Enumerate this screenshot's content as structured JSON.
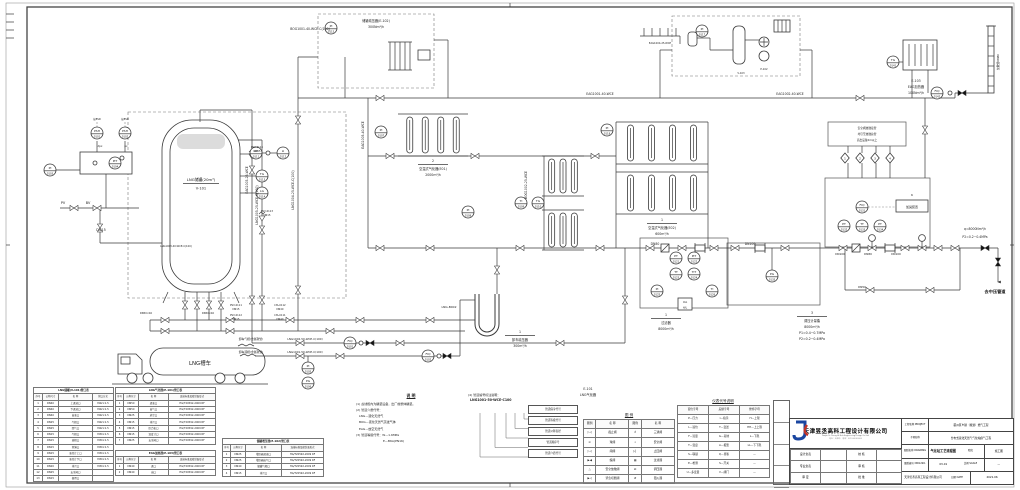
{
  "diagram": {
    "gray_note": "接ESD",
    "tank": {
      "name": "LNG储罐(20m³)",
      "tag": "V-101"
    },
    "truck": "LNG槽车",
    "odorizer": {
      "tag": "6",
      "label": "加臭装置"
    },
    "vent_note_lines": [
      "安全阀放散接管",
      "均引至放散总管",
      "高出设备2m以上"
    ],
    "diamonds": [
      "1",
      "2",
      "3",
      "4"
    ],
    "instruments": [
      {
        "x": 97,
        "y": 133,
        "a": "PSH",
        "b": "0101"
      },
      {
        "x": 125,
        "y": 133,
        "a": "PSH",
        "b": "0102"
      },
      {
        "x": 50,
        "y": 170,
        "a": "PI",
        "b": "0103"
      },
      {
        "x": 115,
        "y": 163,
        "a": "PIT",
        "b": "0104"
      },
      {
        "x": 256,
        "y": 153,
        "a": "LIT",
        "b": "0111"
      },
      {
        "x": 283,
        "y": 153,
        "a": "LI",
        "b": "0112"
      },
      {
        "x": 262,
        "y": 176,
        "a": "TG",
        "b": "0113"
      },
      {
        "x": 262,
        "y": 193,
        "a": "LG",
        "b": "0114"
      },
      {
        "x": 308,
        "y": 368,
        "a": "PI",
        "b": "0105"
      },
      {
        "x": 308,
        "y": 383,
        "a": "PG",
        "b": "0106"
      },
      {
        "x": 350,
        "y": 343,
        "a": "FIQ",
        "b": "0101"
      },
      {
        "x": 428,
        "y": 356,
        "a": "FIQ",
        "b": "0102"
      },
      {
        "x": 381,
        "y": 132,
        "a": "PI",
        "b": "0107"
      },
      {
        "x": 468,
        "y": 212,
        "a": "PI",
        "b": "0108"
      },
      {
        "x": 521,
        "y": 203,
        "a": "TI",
        "b": "0109"
      },
      {
        "x": 538,
        "y": 203,
        "a": "TG",
        "b": "0110"
      },
      {
        "x": 331,
        "y": 28,
        "a": "PI",
        "b": "0115"
      },
      {
        "x": 702,
        "y": 31,
        "a": "PI",
        "b": "0117"
      },
      {
        "x": 607,
        "y": 130,
        "a": "PI",
        "b": "0118"
      },
      {
        "x": 676,
        "y": 258,
        "a": "PT",
        "b": "0121"
      },
      {
        "x": 694,
        "y": 258,
        "a": "PIT",
        "b": "0122"
      },
      {
        "x": 676,
        "y": 274,
        "a": "TT",
        "b": "0123"
      },
      {
        "x": 694,
        "y": 274,
        "a": "TIT",
        "b": "0124"
      },
      {
        "x": 657,
        "y": 291,
        "a": "PI",
        "b": "0125"
      },
      {
        "x": 712,
        "y": 291,
        "a": "TI",
        "b": "0126"
      },
      {
        "x": 685,
        "y": 304,
        "a": "UA",
        "b": "H/L",
        "rect": 1
      },
      {
        "x": 862,
        "y": 207,
        "a": "FIQ",
        "b": "0131"
      },
      {
        "x": 844,
        "y": 226,
        "a": "PT",
        "b": "0132"
      },
      {
        "x": 862,
        "y": 226,
        "a": "TT",
        "b": "0133"
      },
      {
        "x": 880,
        "y": 226,
        "a": "PT",
        "b": "0134"
      },
      {
        "x": 772,
        "y": 276,
        "a": "PG",
        "b": "0135"
      },
      {
        "x": 893,
        "y": 62,
        "a": "TG",
        "b": "0141"
      },
      {
        "x": 937,
        "y": 93,
        "a": "FIQ",
        "b": "0142"
      }
    ],
    "pipe_labels": [
      {
        "x": 310,
        "y": 30,
        "t": "BOG1001-40-WCE-C(100)"
      },
      {
        "x": 600,
        "y": 95,
        "t": "EAG1001-40-WCE"
      },
      {
        "x": 790,
        "y": 95,
        "t": "EAG1002-40-WCE"
      },
      {
        "x": 660,
        "y": 44,
        "t": "EAG1004-25-WCE",
        "s": 2.5
      },
      {
        "x": 364,
        "y": 135,
        "t": "EAG1005-40-WCE",
        "r": -90
      },
      {
        "x": 248,
        "y": 180,
        "t": "EAG1003-25-WCE",
        "r": -90
      },
      {
        "x": 258,
        "y": 205,
        "t": "LNG1005-25-WCE-C(100)",
        "r": -90
      },
      {
        "x": 294,
        "y": 190,
        "t": "LNG1004-25-WCE-C(100)",
        "r": -90
      },
      {
        "x": 527,
        "y": 185,
        "t": "BOG1002-25-WCE",
        "r": -90
      },
      {
        "x": 176,
        "y": 247,
        "t": "LNG1003-40-WCE-C(100)",
        "s": 2.5
      },
      {
        "x": 257,
        "y": 148,
        "t": "PSV-0114",
        "s": 2.5
      },
      {
        "x": 257,
        "y": 152,
        "t": "DN15",
        "s": 2.5
      },
      {
        "x": 267,
        "y": 212,
        "t": "PSV-0113",
        "s": 2.5
      },
      {
        "x": 267,
        "y": 216,
        "t": "DN15",
        "s": 2.5
      },
      {
        "x": 236,
        "y": 306,
        "t": "PSV-0111",
        "s": 2.5
      },
      {
        "x": 236,
        "y": 310,
        "t": "DN15",
        "s": 2.5
      },
      {
        "x": 236,
        "y": 316,
        "t": "PSV-0112",
        "s": 2.5
      },
      {
        "x": 236,
        "y": 320,
        "t": "DN15",
        "s": 2.5
      },
      {
        "x": 280,
        "y": 306,
        "t": "LTA-0112",
        "s": 2.5
      },
      {
        "x": 280,
        "y": 310,
        "t": "DN40",
        "s": 2.5
      },
      {
        "x": 280,
        "y": 316,
        "t": "LTA-0111",
        "s": 2.5
      },
      {
        "x": 280,
        "y": 320,
        "t": "DN40",
        "s": 2.5
      },
      {
        "x": 146,
        "y": 314,
        "t": "DN50×40",
        "s": 2.5
      },
      {
        "x": 208,
        "y": 314,
        "t": "DN50×40",
        "s": 2.5
      },
      {
        "x": 251,
        "y": 340,
        "t": "卸车气相(金属软管)",
        "s": 2.8
      },
      {
        "x": 251,
        "y": 353,
        "t": "卸车液相(金属软管)",
        "s": 2.8
      },
      {
        "x": 305,
        "y": 340,
        "t": "LNG1002-50-WCE-C(100)",
        "s": 2.8
      },
      {
        "x": 305,
        "y": 353,
        "t": "LNG1001-50-WCE-C(100)",
        "s": 2.8
      },
      {
        "x": 449,
        "y": 308,
        "t": "LNG-B002",
        "s": 3
      },
      {
        "x": 655,
        "y": 245,
        "t": "DN80"
      },
      {
        "x": 750,
        "y": 245,
        "t": "DN100"
      },
      {
        "x": 840,
        "y": 255,
        "t": "DN100",
        "s": 2.8
      },
      {
        "x": 868,
        "y": 255,
        "t": "DN80",
        "s": 2.8
      },
      {
        "x": 896,
        "y": 255,
        "t": "DN100",
        "s": 2.8
      },
      {
        "x": 862,
        "y": 288,
        "t": "DN50",
        "s": 2.8
      },
      {
        "x": 975,
        "y": 230,
        "t": "q=8000Nm³/h"
      },
      {
        "x": 975,
        "y": 238,
        "t": "P2=0.2~0.4MPa"
      },
      {
        "x": 995,
        "y": 293,
        "t": "去中压管道",
        "s": 4.2,
        "b": 1
      },
      {
        "x": 101,
        "y": 231,
        "t": "DN15",
        "s": 3.4
      },
      {
        "x": 63,
        "y": 204,
        "t": "PV",
        "s": 3.4
      },
      {
        "x": 88,
        "y": 204,
        "t": "BV",
        "s": 3.4
      },
      {
        "x": 741,
        "y": 74,
        "t": "V-103",
        "s": 2.5
      },
      {
        "x": 764,
        "y": 70,
        "t": "P-102",
        "s": 2.5
      },
      {
        "x": 999,
        "y": 62,
        "t": "放散管DN80",
        "r": -90,
        "s": 2.8
      }
    ],
    "captions": [
      {
        "x": 433,
        "y": 162,
        "n": "2",
        "lines": [
          "空温式气化器(E01)",
          "2000m³/h"
        ]
      },
      {
        "x": 662,
        "y": 221,
        "n": "1",
        "lines": [
          "空温式气化器(E02)",
          "600m³/h"
        ]
      },
      {
        "x": 520,
        "y": 333,
        "n": "1",
        "lines": [
          "卸车增压器",
          "300m³/h"
        ]
      },
      {
        "x": 666,
        "y": 316,
        "n": "1",
        "lines": [
          "过滤器",
          "8000m³/h"
        ]
      },
      {
        "x": 812,
        "y": 314,
        "n": "3",
        "lines": [
          "调压计量撬",
          "8000m³/h",
          "P1=0.4~0.7MPa",
          "P2=0.2~0.4MPa"
        ]
      },
      {
        "x": 916,
        "y": 82,
        "lines": [
          "E-103",
          "EAG加热器",
          "100Nm³/h"
        ]
      },
      {
        "x": 376,
        "y": 22,
        "lines": [
          "储罐增压器(E-102)",
          "300Nm³/h"
        ]
      },
      {
        "x": 588,
        "y": 390,
        "lines": [
          "E-101",
          "LNG气化器"
        ]
      }
    ]
  },
  "notes": {
    "title": "说  明",
    "items": [
      "(1) 虚线框内为橇装设备，出厂前整体橇装。",
      "(2) 管道介质代号：",
      "　LNG—液化天然气",
      "　BOG—液化天然气蒸发气体",
      "　EAG—放空天然气",
      "(3) 管道等级代号：W—1.6MPa",
      "　　　　　　　　　E—B6A(PN16)"
    ]
  },
  "note4": {
    "title": "(4) 管道编号标注说明：",
    "code": "LNG1001-50-WCE-C100",
    "callouts": [
      "管道保冷代号",
      "管道等级代号",
      "管道公称直径",
      "管道顺序号",
      "管道介质代号"
    ]
  },
  "legend": {
    "title": "图  例",
    "table": {
      "headers": [
        "图例",
        "名 称",
        "图例",
        "名 称"
      ],
      "widths": [
        12,
        32,
        12,
        32
      ],
      "rows": [
        [
          "▷◁",
          "截止阀",
          "♁",
          "三通阀"
        ],
        [
          "⊙",
          "球阀",
          "⌖",
          "安全阀"
        ],
        [
          "▷◁",
          "闸阀",
          "▷▏",
          "止回阀"
        ],
        [
          "▶◀",
          "蝶阀",
          "▦",
          "过滤器"
        ],
        [
          "△",
          "安全放散阀",
          "Ω",
          "调压器"
        ],
        [
          "▶◁",
          "紧急切断阀",
          "#",
          "阻火器"
        ]
      ]
    }
  },
  "inst_code": {
    "title": "仪表代号说明",
    "table": {
      "headers": [
        "首位字母",
        "后继字母",
        "修饰字母"
      ],
      "widths": [
        31,
        31,
        30
      ],
      "rows": [
        [
          "P—压力",
          "I—指示",
          "H—上限"
        ],
        [
          "L—液位",
          "T—变送",
          "HH—上上限"
        ],
        [
          "F—流量",
          "G—就地",
          "L—下限"
        ],
        [
          "T—温度",
          "A—报警",
          "LL—下下限"
        ],
        [
          "S—联锁",
          "Q—累积",
          "—"
        ],
        [
          "E—检测",
          "S—开关",
          "—"
        ],
        [
          "U—多变量",
          "V—阀门",
          "—"
        ]
      ]
    }
  },
  "tables": {
    "t1": {
      "title": "LNG储罐(V-101)管口表",
      "headers": [
        "序号",
        "公称尺寸",
        "名 称",
        "管口方式"
      ],
      "widths": [
        9,
        16,
        34,
        21
      ],
      "rows": [
        [
          "1",
          "DN40",
          "上进液口",
          "M42×1.5"
        ],
        [
          "2",
          "DN40",
          "下进液口",
          "M42×1.5"
        ],
        [
          "3",
          "DN40",
          "出液口",
          "M42×1.5"
        ],
        [
          "4",
          "DN25",
          "气相口",
          "M42×1.5"
        ],
        [
          "5",
          "DN25",
          "回气口",
          "M42×1.5"
        ],
        [
          "6",
          "DN15",
          "气相口",
          "M30×1.5"
        ],
        [
          "7",
          "DN15",
          "液相口",
          "M30×1.5"
        ],
        [
          "8",
          "DN15",
          "测满口",
          "M30×1.5"
        ],
        [
          "9",
          "DN15",
          "液位计上口",
          "M30×1.5"
        ],
        [
          "10",
          "DN15",
          "液位计下口",
          "M30×1.5"
        ],
        [
          "11",
          "DN20",
          "排污口",
          "M30×1.5"
        ],
        [
          "12",
          "DN25",
          "安全阀口",
          ""
        ],
        [
          "13",
          "DN15",
          "备用口",
          ""
        ]
      ]
    },
    "t2": {
      "title": "LNG气化器(E-101)管口表",
      "headers": [
        "序号",
        "公称尺寸",
        "名 称",
        "连接标准及密封面形式"
      ],
      "widths": [
        8,
        15,
        30,
        47
      ],
      "rows": [
        [
          "1",
          "DN50",
          "进液口",
          "HG/T20592-2009 RF"
        ],
        [
          "2",
          "DN50",
          "出气口",
          "HG/T20592-2009 RF"
        ],
        [
          "3",
          "DN25",
          "放空口",
          "HG/T20592-2009 RF"
        ],
        [
          "4",
          "DN15",
          "排污口",
          "HG/T20592-2009 RF"
        ],
        [
          "5",
          "DN15",
          "压力表口",
          "HG/T20592-2009 RF"
        ],
        [
          "6",
          "DN15",
          "温度计口",
          "HG/T20592-2009 RF"
        ],
        [
          "7",
          "DN25",
          "安全阀口",
          "HG/T20592-2009 RF"
        ]
      ]
    },
    "t2b": {
      "title": "EAG加热器(E-103)管口表",
      "headers": [
        "序号",
        "公称尺寸",
        "名 称",
        "连接标准及密封面形式"
      ],
      "widths": [
        8,
        15,
        30,
        47
      ],
      "rows": [
        [
          "1",
          "DN40",
          "进口",
          "HG/T20592-2009 RF"
        ],
        [
          "2",
          "DN40",
          "出口",
          "HG/T20592-2009 RF"
        ]
      ]
    },
    "t3": {
      "title": "储罐增压器(E-102)管口表",
      "headers": [
        "序号",
        "公称尺寸",
        "名 称",
        "连接标准及密封面形式"
      ],
      "widths": [
        8,
        15,
        36,
        42
      ],
      "rows": [
        [
          "1",
          "DN25",
          "增压器进液口",
          "HG/T20592-2009 RF"
        ],
        [
          "2",
          "DN25",
          "增压器出气口",
          "HG/T20592-2009 RF"
        ],
        [
          "3",
          "DN40",
          "储罐气相口",
          "HG/T20592-2009 RF"
        ],
        [
          "4",
          "DN15",
          "排污口",
          "HG/T20592-2009 RF"
        ]
      ]
    }
  },
  "titleblock": {
    "company": "天津昱丞高科工程设计有限公司",
    "company_en": "Tianjin Yu Cheng Hi-Tech Engineering Design Co.,Ltd.",
    "addr1": "地址：天津市　电话：022-00000000",
    "f1": "工程名称 PROJECT",
    "v1": "蓟州区乡镇（规划）燃气工程",
    "f2": "子项名称",
    "v2": "分布式液化天然气气化站供气工程",
    "f3": "图纸名称 DRAWING",
    "v3": "气化站工艺流程图",
    "f3b": "阶段",
    "v3b": "施工图",
    "f4": "图纸编号 DWG NO.",
    "v4": "03-01",
    "f4b": "比例 SCALE",
    "v4b": "—",
    "f5": "日期 DATE",
    "v5": "2021.06",
    "company2": "天津昱丞高科工程设计有限公司",
    "sign": {
      "widths": [
        30,
        26,
        30,
        25
      ],
      "rows": [
        [
          "设计负责",
          "",
          "校 核",
          ""
        ],
        [
          "专业负责",
          "",
          "审 核",
          ""
        ],
        [
          "审 定",
          "",
          "批 准",
          ""
        ]
      ]
    }
  }
}
